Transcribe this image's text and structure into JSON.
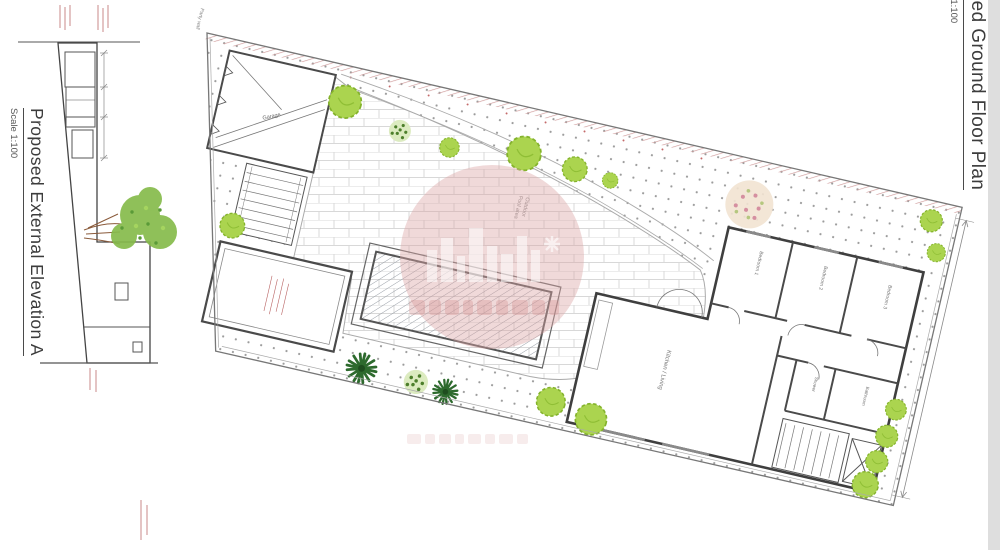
{
  "left_panel": {
    "title": "Proposed External Elevation A",
    "scale": "Scale 1:100"
  },
  "right_panel": {
    "title": "Proposed Ground Floor Plan",
    "scale": "Scale 1:100"
  },
  "plan": {
    "labels": {
      "garage": "Garage",
      "pool_area_line1": "Outdoor",
      "pool_area_line2": "Pool area",
      "living": "Kitchen / Living",
      "bedroom1": "Bedroom 1",
      "bedroom2": "Bedroom 2",
      "bedroom3": "Bedroom 3",
      "bathroom": "Bathroom",
      "shower": "Shower",
      "party_wall": "Party wall"
    }
  },
  "colors": {
    "paper": "#ffffff",
    "line": "#4a4a4a",
    "light_line": "#aaaaaa",
    "bush_green": "#abd44f",
    "palm_green": "#2d6a2d",
    "flower_pink": "#d58fa0",
    "hatch_pink": "#cf9a9a",
    "annotation_red": "#b05050",
    "watermark_pink": "#dca4a4"
  }
}
